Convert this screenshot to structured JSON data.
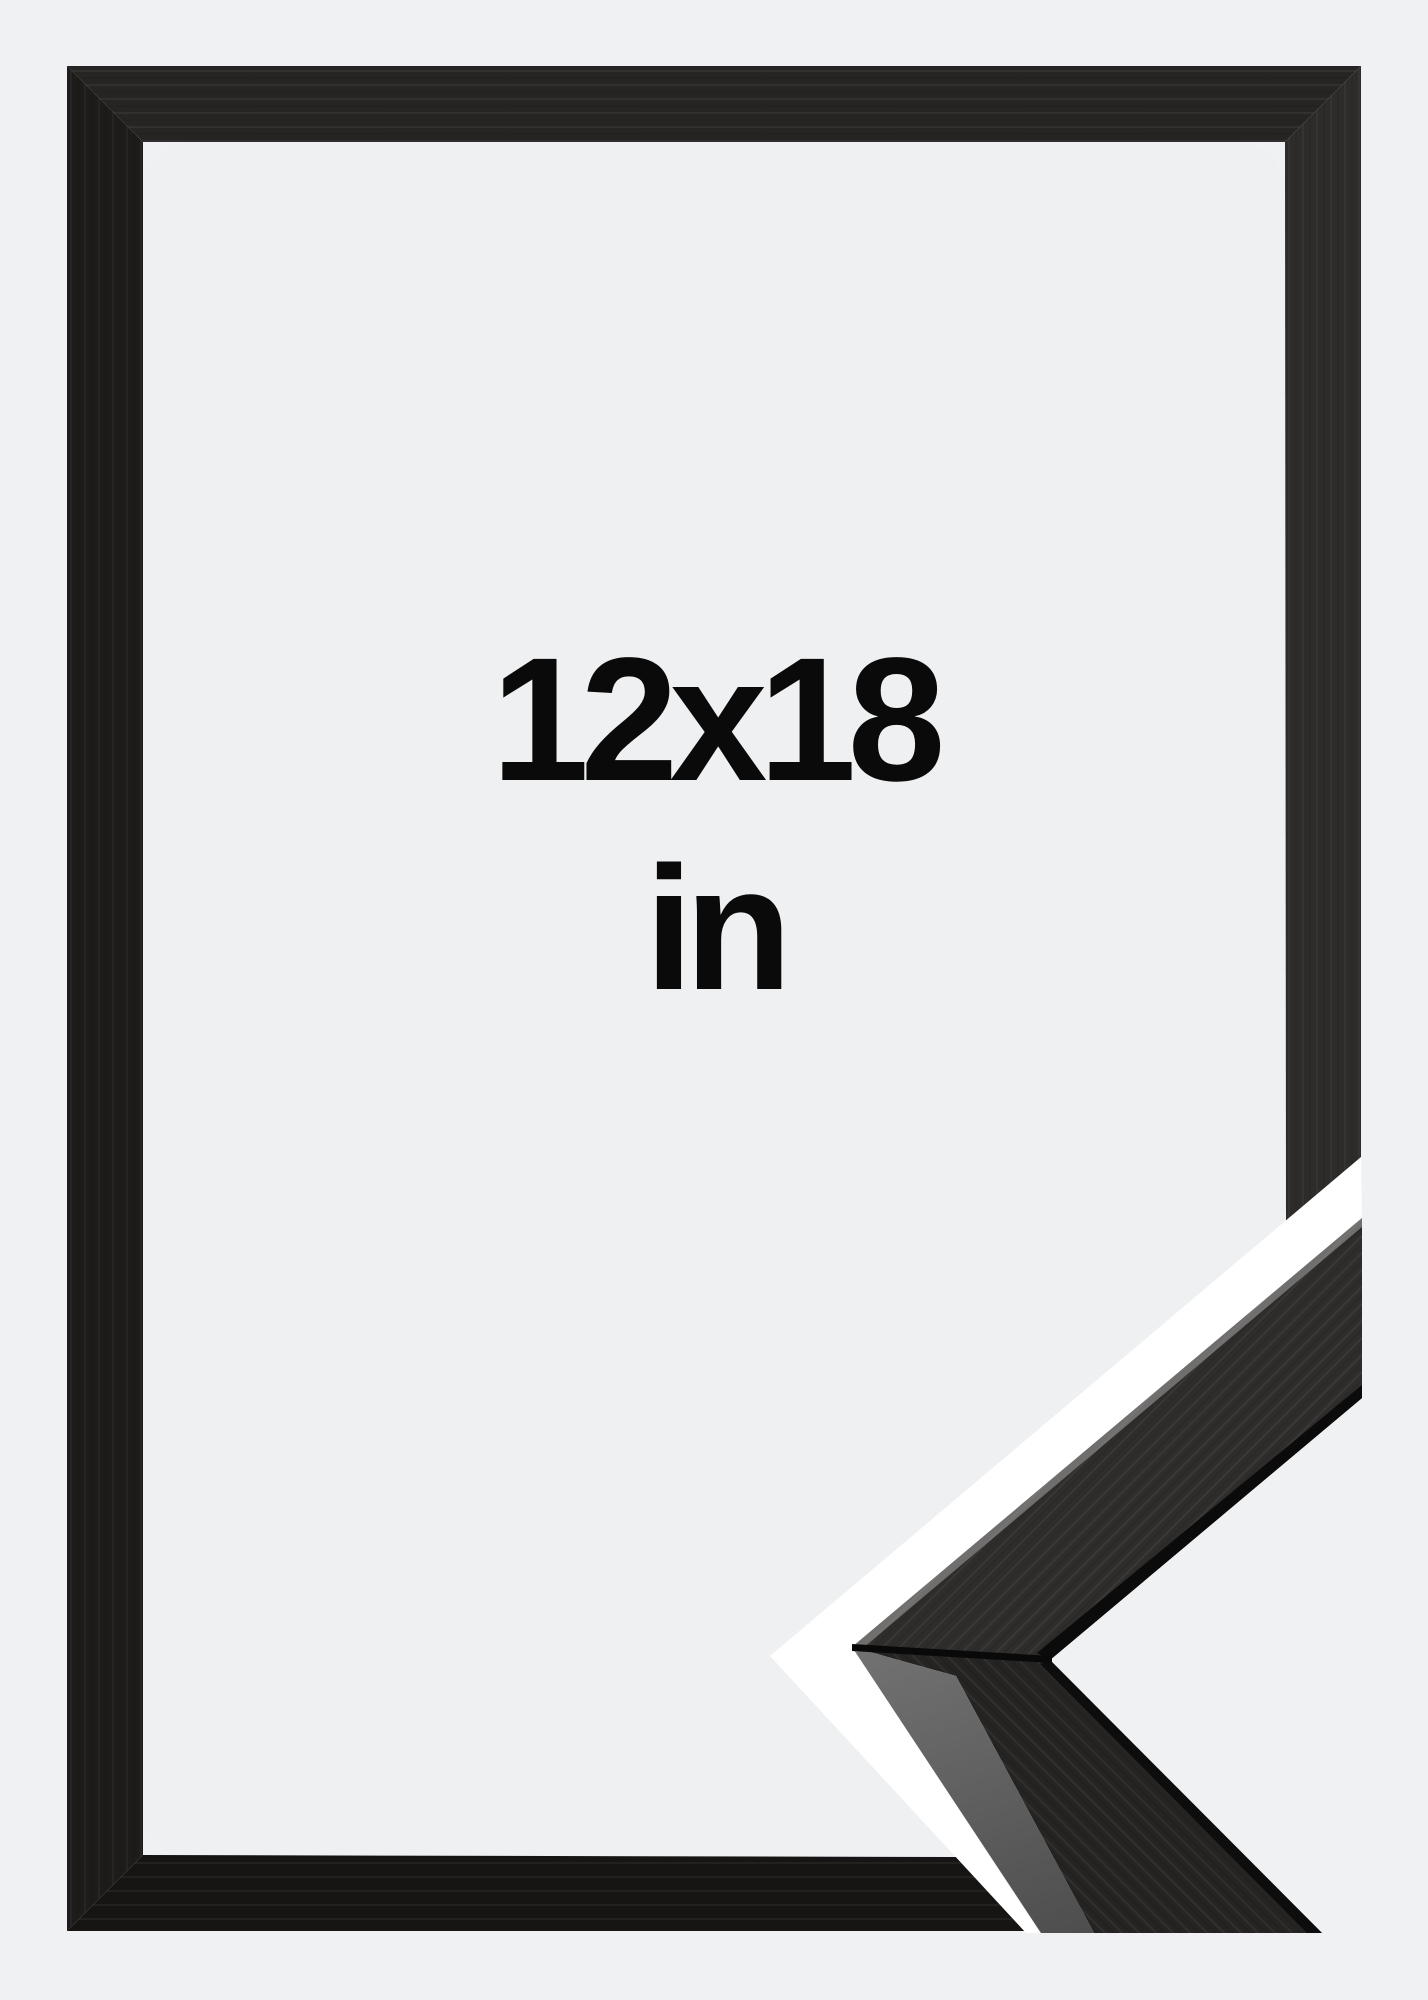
{
  "image_type": "product-photo",
  "product": {
    "size_label": "12x18",
    "unit_label": "in",
    "subject": "black wooden picture frame shown with mitered corner profile sample"
  },
  "colors": {
    "background": "#f0f1f3",
    "interior_base": "#eef0f2",
    "interior_glow": "#ffffff",
    "frame_top": "#272524",
    "frame_right": "#2e2c2a",
    "frame_bottom": "#171514",
    "frame_left": "#1e1c1b",
    "sample_upper_face": "#2f2d2b",
    "sample_lower_face": "#262422",
    "sample_bevel_light": "#8a8a8a",
    "sample_bevel_dark": "#2a2a2a",
    "divider_stripe": "#ffffff",
    "text": "#0a0a0a"
  }
}
